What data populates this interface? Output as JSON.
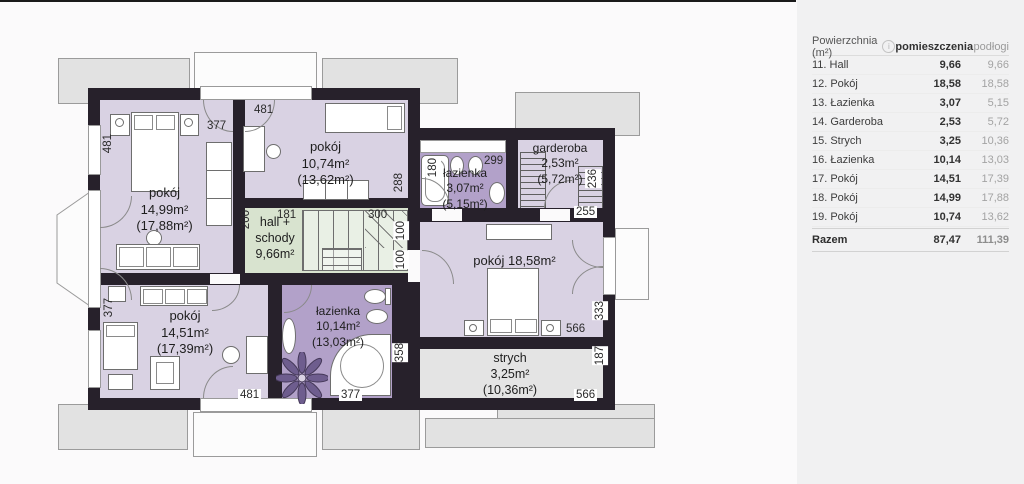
{
  "panel": {
    "table": {
      "area_header": "Powierzchnia (m²)",
      "info_icon": "i",
      "col_rooms": "pomieszczenia",
      "col_floors": "podłogi",
      "rows": [
        {
          "name": "11. Hall",
          "rooms": "9,66",
          "floors": "9,66"
        },
        {
          "name": "12. Pokój",
          "rooms": "18,58",
          "floors": "18,58"
        },
        {
          "name": "13. Łazienka",
          "rooms": "3,07",
          "floors": "5,15"
        },
        {
          "name": "14. Garderoba",
          "rooms": "2,53",
          "floors": "5,72"
        },
        {
          "name": "15. Strych",
          "rooms": "3,25",
          "floors": "10,36"
        },
        {
          "name": "16. Łazienka",
          "rooms": "10,14",
          "floors": "13,03"
        },
        {
          "name": "17. Pokój",
          "rooms": "14,51",
          "floors": "17,39"
        },
        {
          "name": "18. Pokój",
          "rooms": "14,99",
          "floors": "17,88"
        },
        {
          "name": "19. Pokój",
          "rooms": "10,74",
          "floors": "13,62"
        }
      ],
      "total": {
        "name": "Razem",
        "rooms": "87,47",
        "floors": "111,39"
      }
    }
  },
  "plan": {
    "rooms": {
      "pokoj_nw": {
        "name": "pokój",
        "area": "14,99m²",
        "floor": "(17,88m²)"
      },
      "pokoj_n": {
        "name": "pokój",
        "area": "10,74m²",
        "floor": "(13,62m²)"
      },
      "lazienka_n": {
        "name": "łazienka",
        "area": "3,07m²",
        "floor": "(5,15m²)"
      },
      "garderoba": {
        "name": "garderoba",
        "area": "2,53m²",
        "floor": "(5,72m²)"
      },
      "hall": {
        "line1": "hall +",
        "line2": "schody",
        "area": "9,66m²"
      },
      "pokoj_e": {
        "name": "pokój 18,58m²"
      },
      "pokoj_sw": {
        "name": "pokój",
        "area": "14,51m²",
        "floor": "(17,39m²)"
      },
      "lazienka_s": {
        "name": "łazienka",
        "area": "10,14m²",
        "floor": "(13,03m²)"
      },
      "strych": {
        "name": "strych",
        "area": "3,25m²",
        "floor": "(10,36m²)"
      }
    },
    "dims": {
      "nw_left": "481",
      "n_top_left": "377",
      "n_top": "481",
      "n_right": "288",
      "bath_tub": "180",
      "bath_top": "299",
      "gard_right": "236",
      "gard_bottom": "255",
      "hall_left": "200",
      "hall_top_left": "181",
      "hall_top_right": "300",
      "hall_r1": "100",
      "hall_r2": "100",
      "pokoj_e_bottom": "566",
      "pokoj_e_right": "333",
      "strych_right": "187",
      "strych_bottom": "566",
      "sw_left": "377",
      "sw_bottom": "481",
      "bath2_right": "358",
      "bath2_bottom": "377"
    },
    "colors": {
      "room_purple": "#d9d2e3",
      "bath_purple": "#b2a1c9",
      "hall_green": "#d8e3cf",
      "attic_gray": "#e4e4e4",
      "wall": "#27212b"
    }
  }
}
